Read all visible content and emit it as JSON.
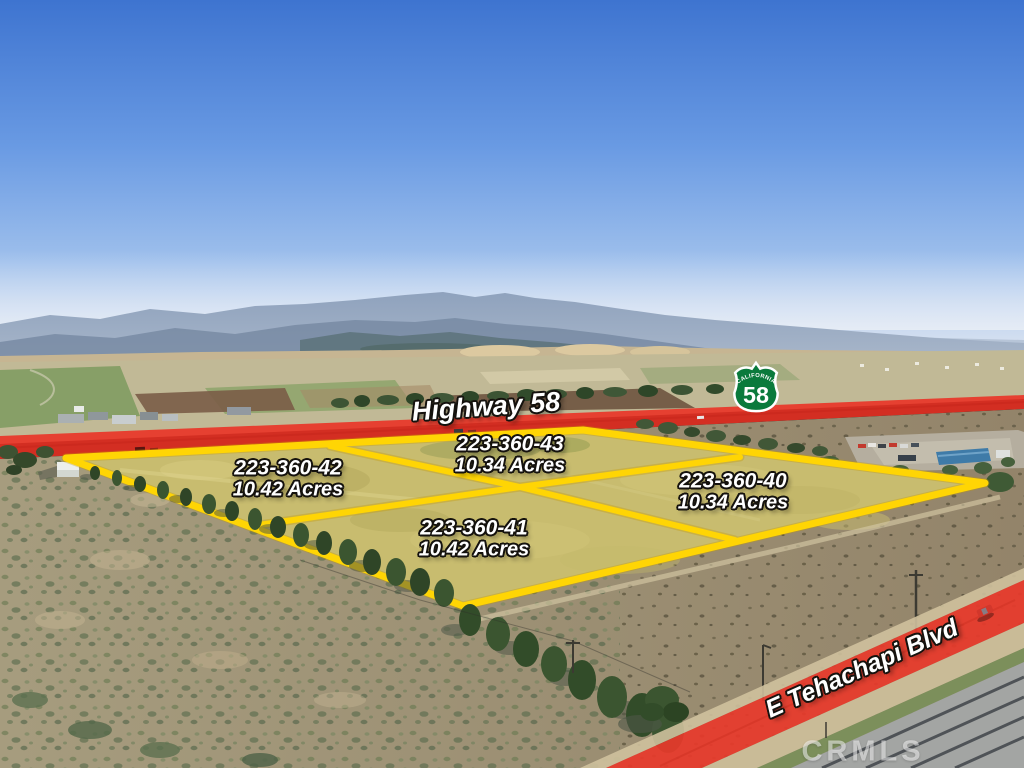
{
  "overlays": {
    "highway_label": "Highway 58",
    "street_label": "E Tehachapi Blvd",
    "watermark": "CRMLS",
    "shield": {
      "state": "CALIFORNIA",
      "route": "58"
    },
    "parcels": [
      {
        "apn": "223-360-42",
        "acres": "10.42 Acres"
      },
      {
        "apn": "223-360-43",
        "acres": "10.34 Acres"
      },
      {
        "apn": "223-360-40",
        "acres": "10.34 Acres"
      },
      {
        "apn": "223-360-41",
        "acres": "10.42 Acres"
      }
    ],
    "colors": {
      "parcel_line": "#ffd504",
      "road_highlight": "#e8392b",
      "shield_green": "#0a7a3c"
    }
  }
}
